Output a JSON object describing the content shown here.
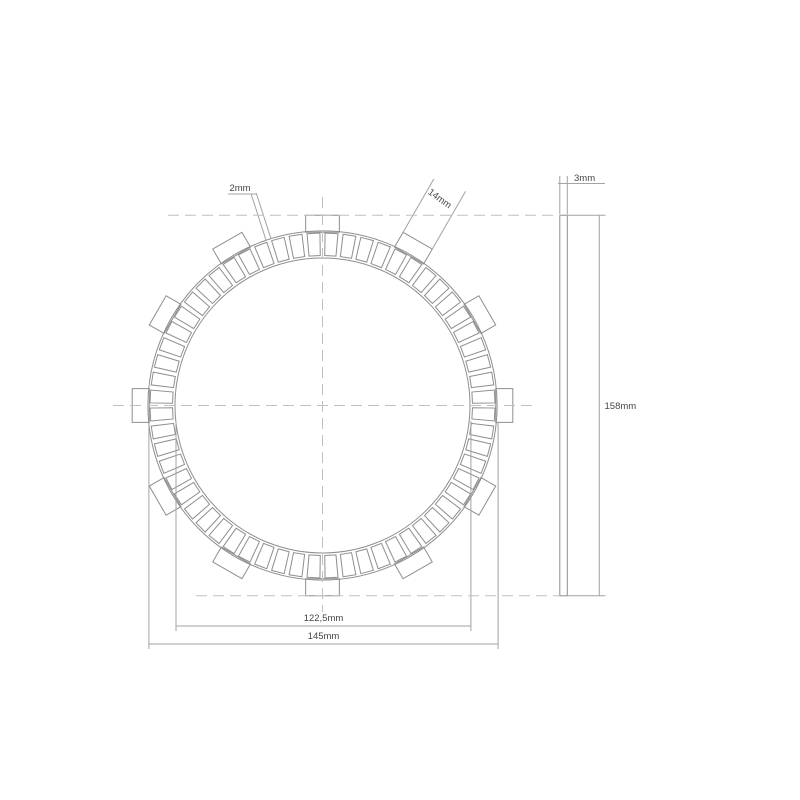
{
  "drawing_title": "clutch friction plate technical drawing",
  "colors": {
    "background": "#ffffff",
    "outline": "#8e8e8e",
    "dimension_line": "#a3a3a3",
    "centerline": "#c0c0c0",
    "label_text": "#454545"
  },
  "front_view": {
    "center_x": 322.5,
    "center_y": 405.5,
    "bore_radius": 147.5,
    "outer_radius": 174.6,
    "pad_count": 60,
    "pad_pitch_deg": 6,
    "pad_gap_deg": 1.7,
    "pad_inner_radius": 150,
    "pad_outer_radius": 172.5,
    "tab_count": 12,
    "tab_spacing_deg": 30,
    "tab_inner_radius": 173.2,
    "tab_outer_radius": 190.3,
    "tab_width_px": 33.7
  },
  "side_view": {
    "left": 559.8,
    "width": 7.5,
    "top": 215.2,
    "bottom": 595.8
  },
  "centerlines": [
    [
      113,
      405.5,
      533,
      405.5
    ],
    [
      322.5,
      197,
      322.5,
      612
    ],
    [
      168,
      215.2,
      559.8,
      215.2
    ],
    [
      196,
      595.8,
      559.8,
      595.8
    ]
  ],
  "dimension_lines": [
    [
      176,
      421,
      176,
      631
    ],
    [
      470.9,
      421,
      470.9,
      631
    ],
    [
      148.9,
      423,
      148.9,
      649
    ],
    [
      498.1,
      423,
      498.1,
      649
    ],
    [
      176,
      626,
      470.9,
      626
    ],
    [
      148.9,
      644,
      498.1,
      644
    ],
    [
      559.8,
      214,
      559.8,
      176
    ],
    [
      567.3,
      214,
      567.3,
      176
    ],
    [
      558,
      183.5,
      605,
      183.5
    ],
    [
      567.3,
      215.2,
      605.5,
      215.2
    ],
    [
      567.3,
      595.8,
      605.5,
      595.8
    ],
    [
      599.3,
      215.2,
      599.3,
      595.8
    ],
    [
      228,
      194,
      256.2,
      194
    ],
    [
      266.1,
      240.3,
      251.3,
      194.6
    ],
    [
      271.0,
      238.7,
      256.2,
      193.0
    ],
    [
      402.9,
      232.6,
      433.9,
      178.9
    ],
    [
      432.1,
      249.4,
      465.6,
      191.3
    ]
  ],
  "labels": [
    {
      "id": "dim-label-2mm",
      "text": "2mm",
      "x": 240,
      "y": 191,
      "anchor": "middle",
      "rotate": 0
    },
    {
      "id": "dim-label-14mm",
      "text": "14mm",
      "x": 438,
      "y": 201,
      "anchor": "middle",
      "rotate": 36
    },
    {
      "id": "dim-label-3mm",
      "text": "3mm",
      "x": 574,
      "y": 181,
      "anchor": "start",
      "rotate": 0
    },
    {
      "id": "dim-label-158mm",
      "text": "158mm",
      "x": 604.5,
      "y": 409,
      "anchor": "start",
      "rotate": 0
    },
    {
      "id": "dim-label-122-5mm",
      "text": "122,5mm",
      "x": 323.5,
      "y": 621,
      "anchor": "middle",
      "rotate": 0
    },
    {
      "id": "dim-label-145mm",
      "text": "145mm",
      "x": 323.5,
      "y": 639,
      "anchor": "middle",
      "rotate": 0
    }
  ]
}
